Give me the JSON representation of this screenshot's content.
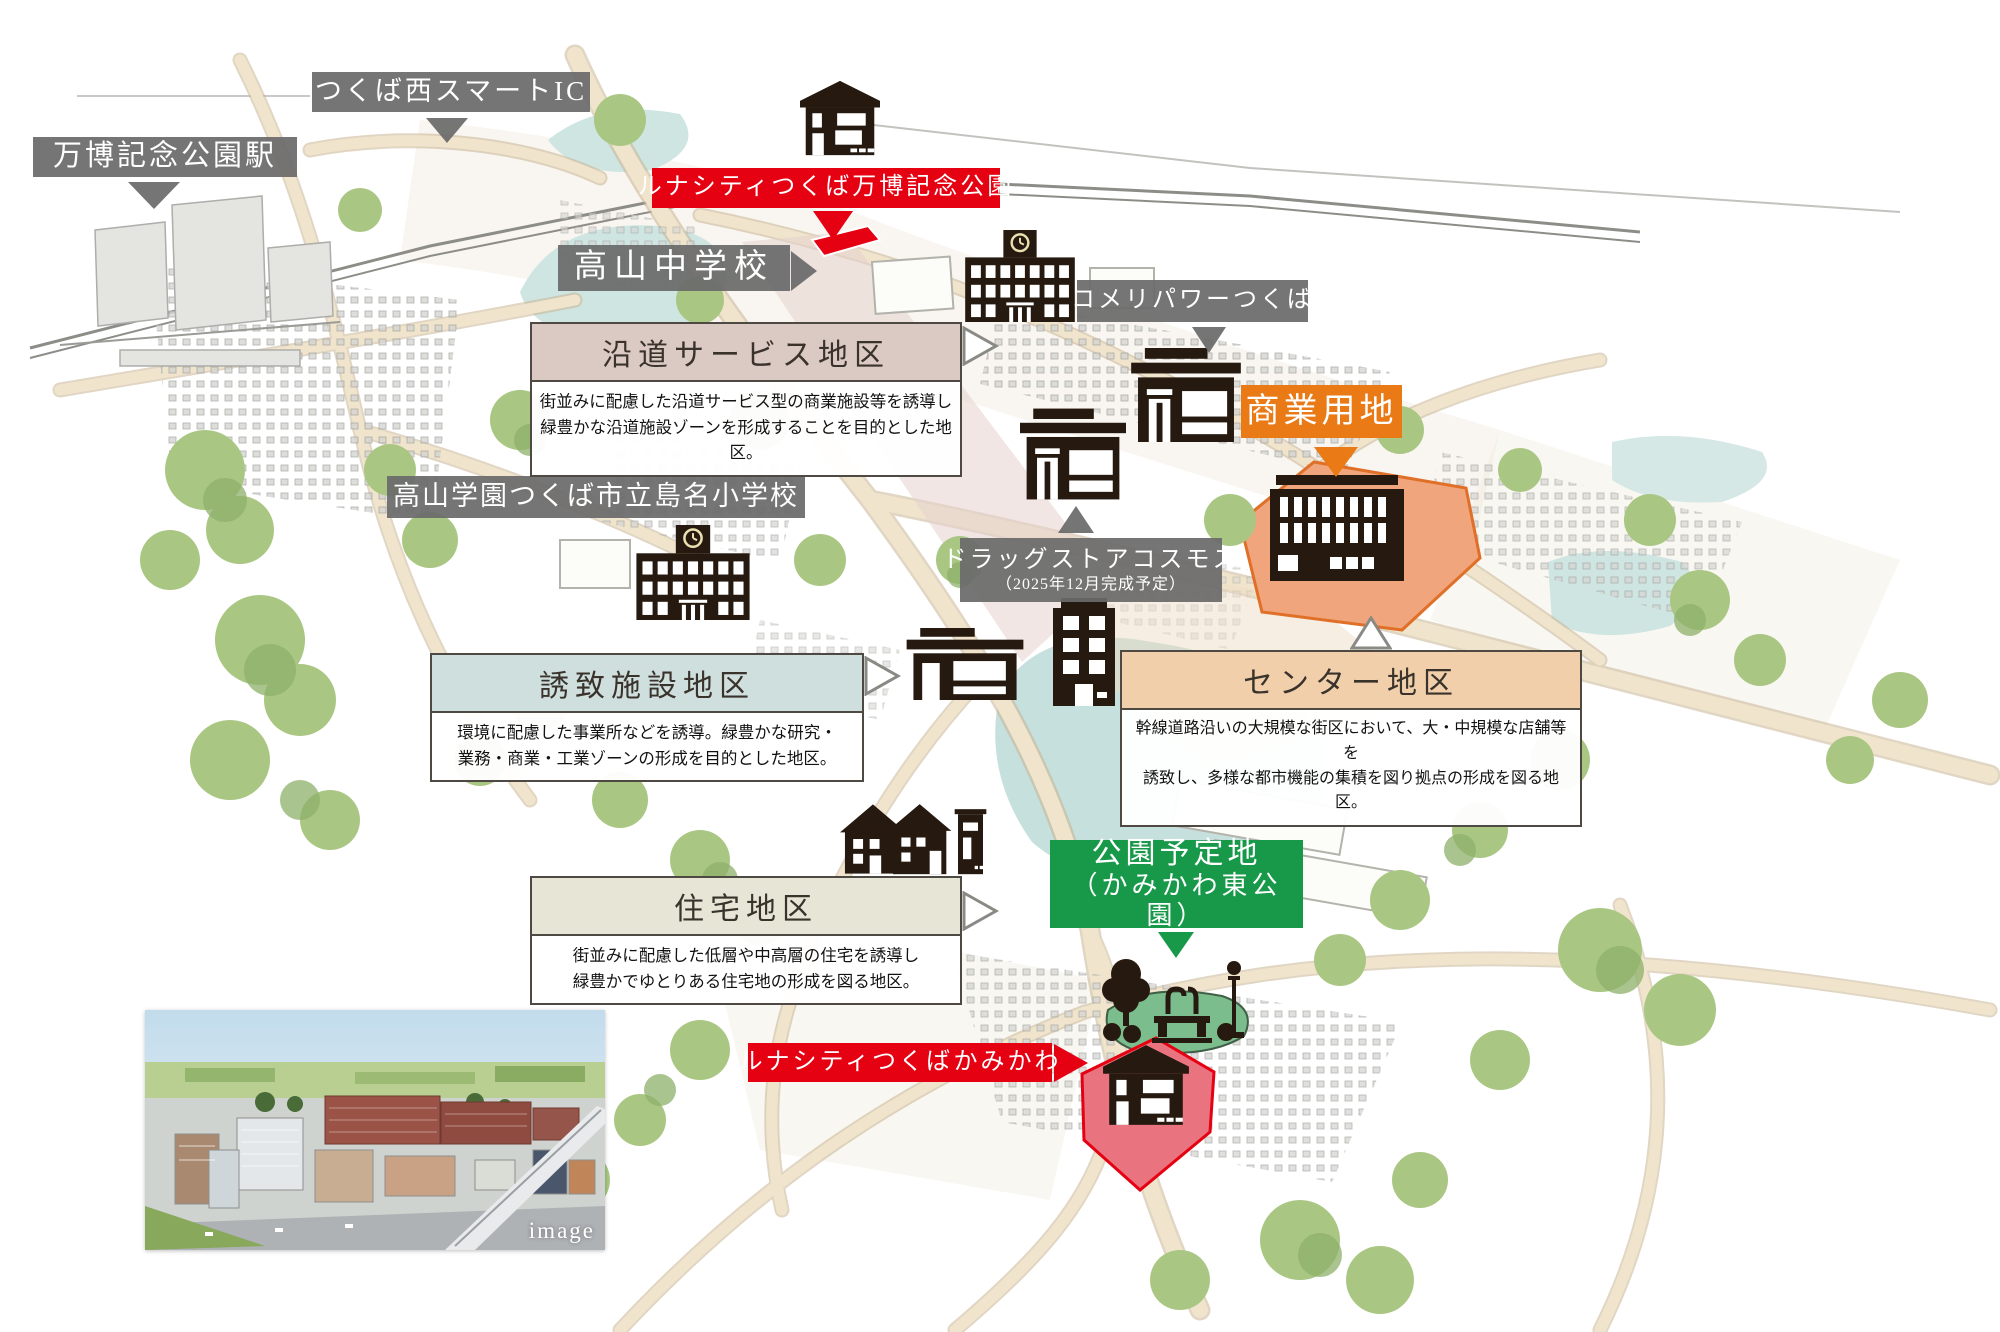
{
  "labels": {
    "station": "万博記念公園駅",
    "smart_ic": "つくば西スマートIC",
    "lunacity_banpaku": "ルナシティつくば万博記念公園",
    "junior_high": "高山中学校",
    "komeri": "コメリパワーつくば",
    "commercial_land": "商業用地",
    "elementary": "高山学園つくば市立島名小学校",
    "drugstore": "ドラッグストアコスモス",
    "drugstore_note": "（2025年12月完成予定）",
    "park_line1": "公園予定地",
    "park_line2": "（かみかわ東公園）",
    "lunacity_kamikawa": "ルナシティつくばかみかわ"
  },
  "districts": [
    {
      "name": "沿道サービス地区",
      "desc1": "街並みに配慮した沿道サービス型の商業施設等を誘導し",
      "desc2": "緑豊かな沿道施設ゾーンを形成することを目的とした地区。",
      "header_color": "#dbc9c4"
    },
    {
      "name": "誘致施設地区",
      "desc1": "環境に配慮した事業所などを誘導。緑豊かな研究・",
      "desc2": "業務・商業・工業ゾーンの形成を目的とした地区。",
      "header_color": "#cfdfde"
    },
    {
      "name": "センター地区",
      "desc1": "幹線道路沿いの大規模な街区において、大・中規模な店舗等を",
      "desc2": "誘致し、多様な都市機能の集積を図り拠点の形成を図る地区。",
      "header_color": "#f1cfab"
    },
    {
      "name": "住宅地区",
      "desc1": "街並みに配慮した低層や中高層の住宅を誘導し",
      "desc2": "緑豊かでゆとりある住宅地の形成を図る地区。",
      "header_color": "#e7e5d6"
    }
  ],
  "photo": {
    "caption": "image"
  },
  "colors": {
    "label_gray": "#6a6a6a",
    "accent_red": "#e50012",
    "accent_orange": "#ea7a15",
    "accent_green": "#18994a",
    "commercial_plot_fill": "#f0a57c",
    "park_fill": "#7cbd8d",
    "red_plot_fill": "#ea7380",
    "water": "#cfe5e2",
    "road": "#f0e5cc"
  },
  "icons": {
    "house": "house-icon",
    "school": "school-icon",
    "store": "store-icon",
    "commercial_building": "commercial-building-icon",
    "apartment": "apartment-icon",
    "park": "park-icon",
    "arrow": "arrow-icon"
  }
}
